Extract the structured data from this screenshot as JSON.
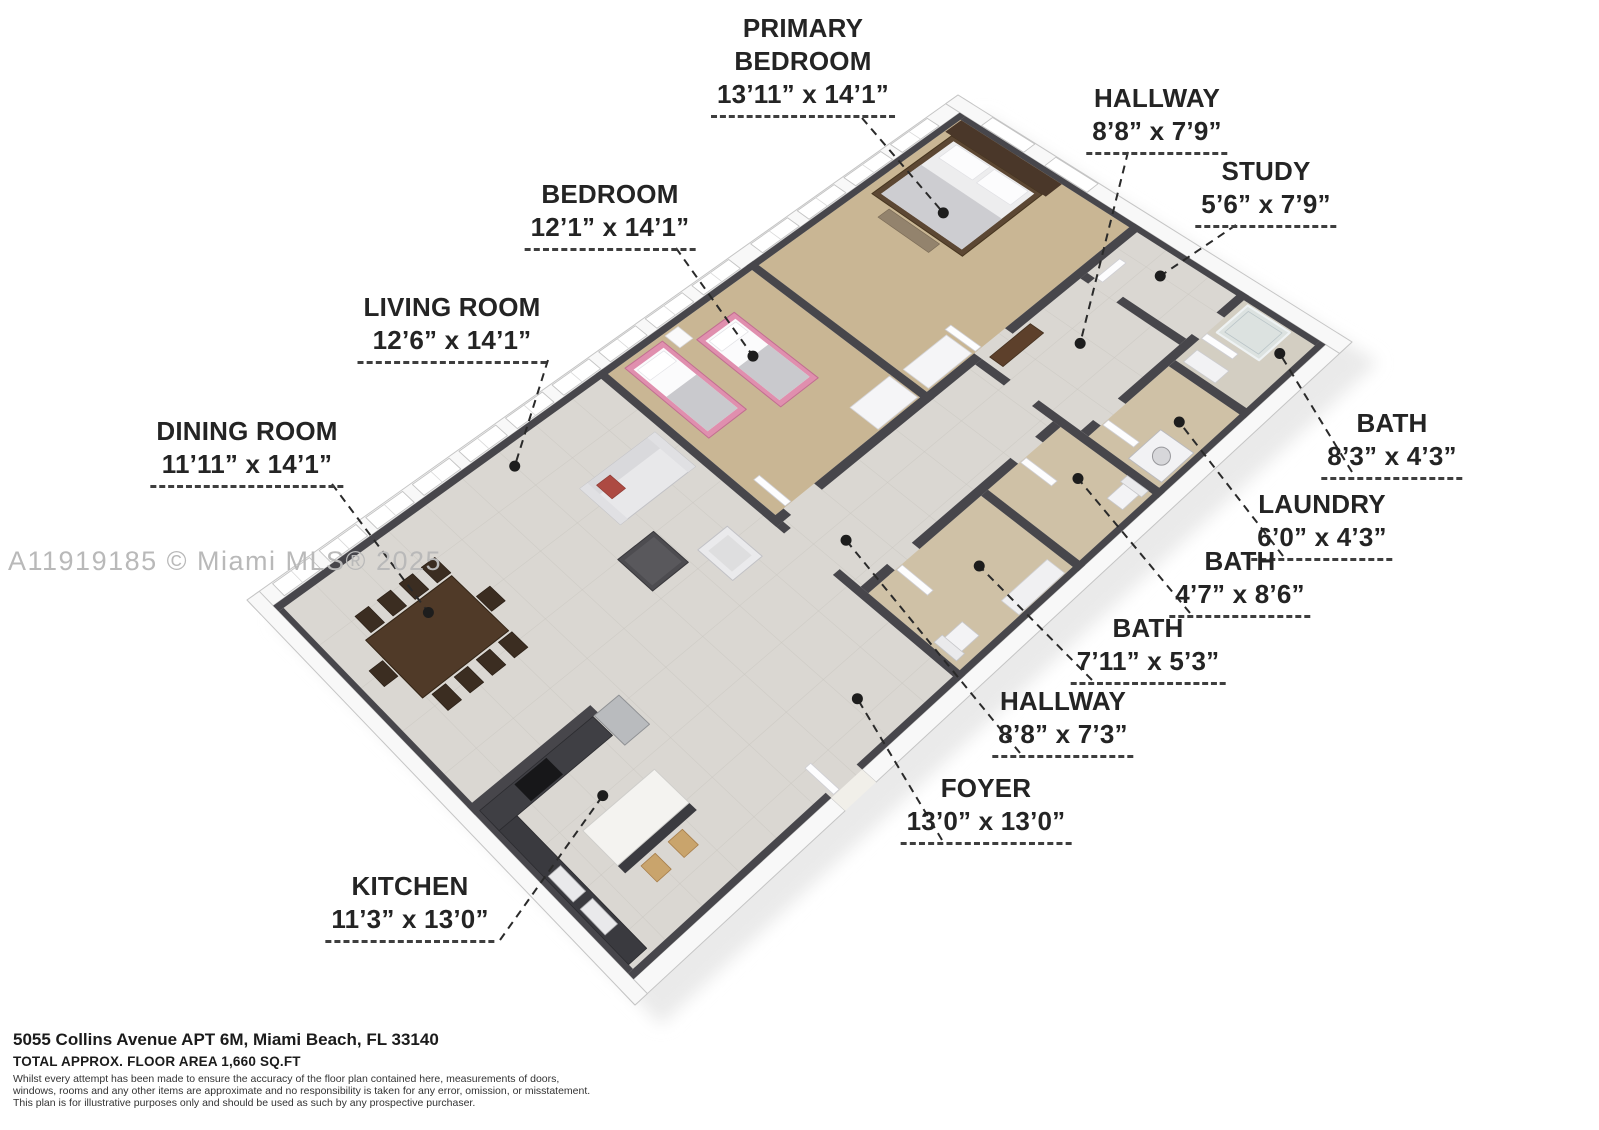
{
  "watermark": "A11919185 © Miami MLS® 2025",
  "rooms": [
    {
      "id": "primary-bedroom",
      "lines": [
        "PRIMARY",
        "BEDROOM"
      ],
      "dims": "13’11” x 14’1”"
    },
    {
      "id": "hallway-upper",
      "lines": [
        "HALLWAY"
      ],
      "dims": "8’8” x 7’9”"
    },
    {
      "id": "study",
      "lines": [
        "STUDY"
      ],
      "dims": "5’6” x 7’9”"
    },
    {
      "id": "bedroom",
      "lines": [
        "BEDROOM"
      ],
      "dims": "12’1” x 14’1”"
    },
    {
      "id": "living-room",
      "lines": [
        "LIVING ROOM"
      ],
      "dims": "12’6” x 14’1”"
    },
    {
      "id": "dining-room",
      "lines": [
        "DINING ROOM"
      ],
      "dims": "11’11” x 14’1”"
    },
    {
      "id": "bath-corner",
      "lines": [
        "BATH"
      ],
      "dims": "8’3” x 4’3”"
    },
    {
      "id": "laundry",
      "lines": [
        "LAUNDRY"
      ],
      "dims": "6’0” x 4’3”"
    },
    {
      "id": "bath-mid",
      "lines": [
        "BATH"
      ],
      "dims": "4’7” x 8’6”"
    },
    {
      "id": "bath-lower",
      "lines": [
        "BATH"
      ],
      "dims": "7’11” x 5’3”"
    },
    {
      "id": "hallway-lower",
      "lines": [
        "HALLWAY"
      ],
      "dims": "8’8” x 7’3”"
    },
    {
      "id": "foyer",
      "lines": [
        "FOYER"
      ],
      "dims": "13’0” x 13’0”"
    },
    {
      "id": "kitchen",
      "lines": [
        "KITCHEN"
      ],
      "dims": "11’3” x 13’0”"
    }
  ],
  "footer": {
    "address": "5055 Collins Avenue APT 6M, Miami Beach, FL 33140",
    "area": "TOTAL APPROX. FLOOR AREA 1,660 SQ.FT",
    "disclaimer_lines": [
      "Whilst every attempt has been made to ensure the accuracy of the floor plan contained here, measurements of doors,",
      "windows, rooms and any other items are approximate and no responsibility is taken for any error, omission, or misstatement.",
      "This plan is for illustrative purposes only and should be used as such by any prospective purchaser."
    ]
  },
  "colors": {
    "wall_dark": "#47464b",
    "wall_outer": "#f8f8f8",
    "wall_outer_edge": "#c5c5c5",
    "floor_tile": "#dad7d2",
    "floor_grid": "#c8c5bf",
    "carpet": "#c9b694",
    "bath_floor": "#cfc1a6",
    "bath_floor_light": "#d3cec2",
    "shadow": "#eaeaea",
    "leader": "#2a2a2a",
    "dot": "#1d1d1d",
    "pink_bed": "#e08fae",
    "pink_bed_edge": "#c26e91",
    "wood_dark": "#503a28",
    "wood_mid": "#5d402b",
    "steel": "#b9bbbe",
    "blanket": "#c9c9cd",
    "white_obj": "#f2f2f4"
  }
}
